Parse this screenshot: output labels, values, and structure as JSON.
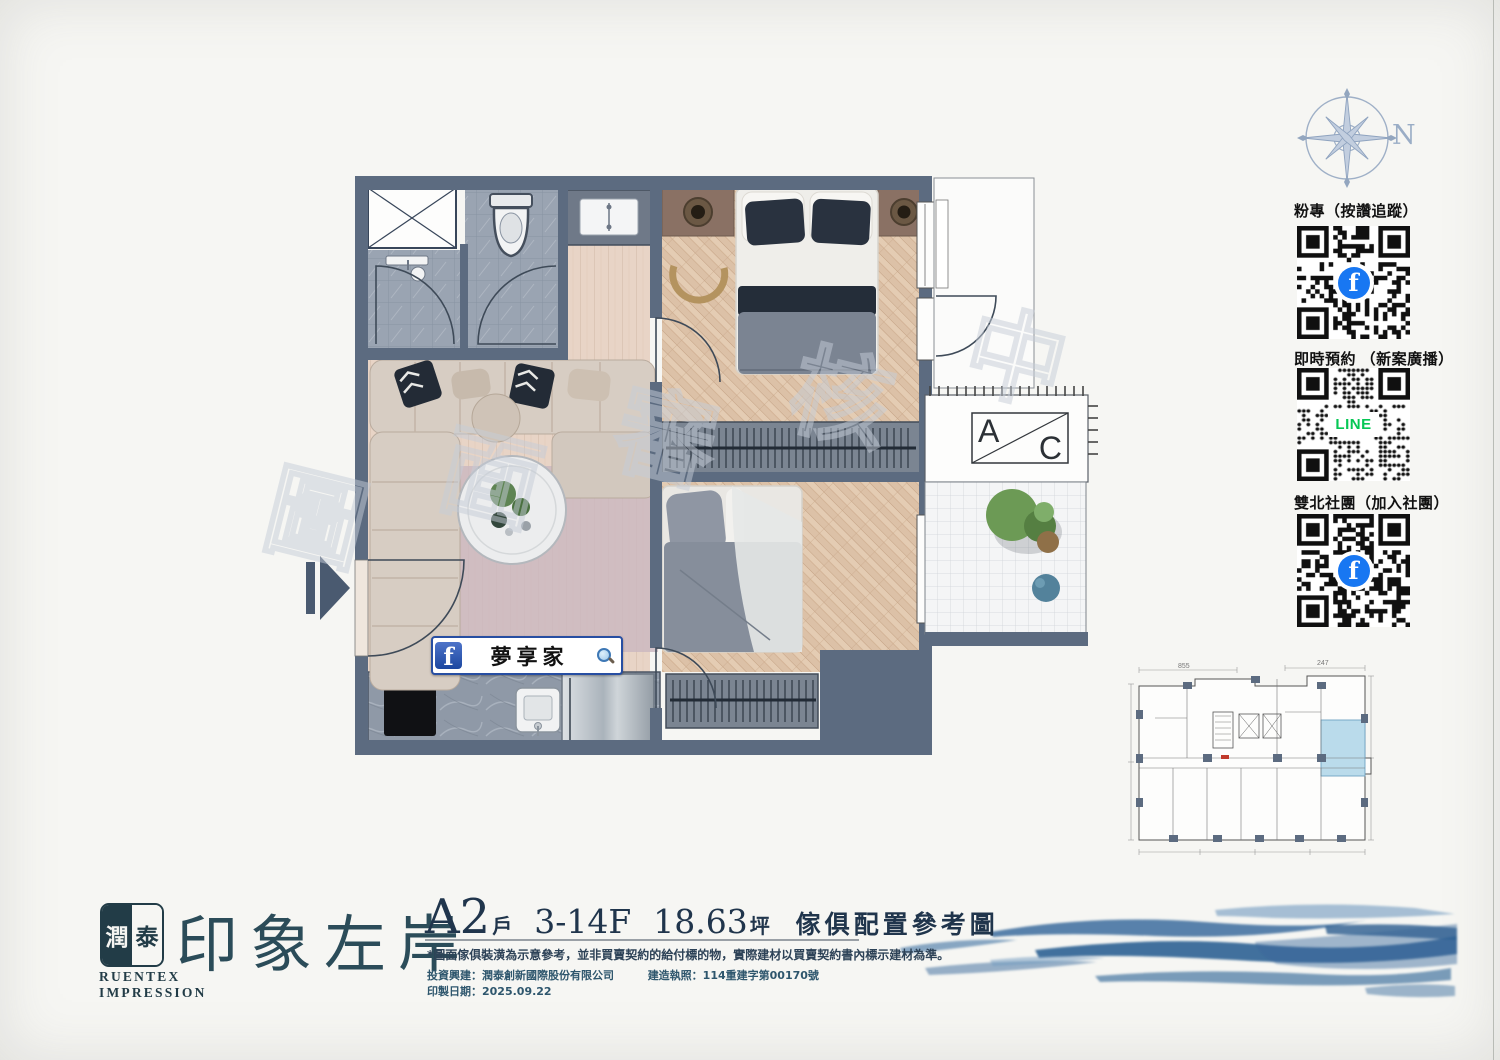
{
  "watermark": {
    "chars": [
      "圖",
      "面",
      "審",
      "核",
      "中"
    ]
  },
  "compass": {
    "north_label": "N"
  },
  "qr_panel": {
    "items": [
      {
        "label": "粉專（按讚追蹤）",
        "logo": "facebook"
      },
      {
        "label": "即時預約 （新案廣播）",
        "logo": "line",
        "logo_text": "LINE"
      },
      {
        "label": "雙北社團（加入社團）",
        "logo": "facebook"
      }
    ]
  },
  "icons": {
    "facebook_f": "f"
  },
  "floor_plan": {
    "ac_unit": {
      "left": "A",
      "right": "C"
    },
    "fb_badge": {
      "name": "夢享家"
    }
  },
  "key_plan": {
    "dims": {
      "top_left": "855",
      "top_right": "247"
    }
  },
  "brand": {
    "seal_left": "潤",
    "seal_right": "泰",
    "en_line1": "RUENTEX",
    "en_line2": "IMPRESSION",
    "project": "印象左岸"
  },
  "title_block": {
    "unit": "A2",
    "unit_suffix": "戶",
    "floors": "3-14F",
    "area": "18.63",
    "area_unit": "坪",
    "subtitle": "傢俱配置參考圖",
    "disclaimer": "*圖面傢俱裝潢為示意參考，並非買賣契約的給付標的物，實際建材以買賣契約書內標示建材為準。",
    "builder": "投資興建：潤泰創新國際股份有限公司",
    "license": "建造執照：114重建字第00170號",
    "print_date": "印製日期：2025.09.22"
  },
  "colors": {
    "wall_slate": "#5c6b80",
    "brand_teal": "#2b4c59",
    "facebook_blue": "#1877f2",
    "line_green": "#06c755",
    "wave_blue": "#3e6f9e",
    "highlight_unit": "#badbeb"
  }
}
